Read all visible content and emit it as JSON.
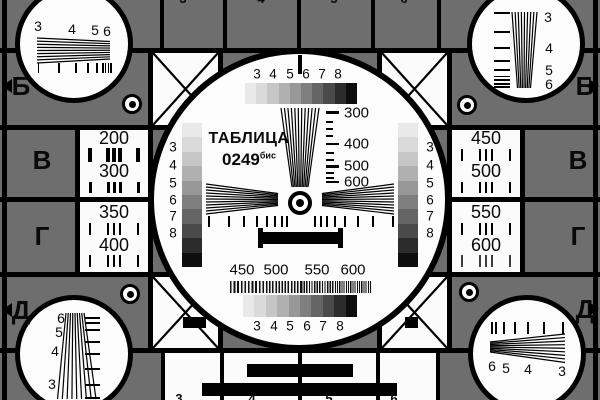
{
  "colors": {
    "background_gray": "#6e6e6e",
    "line_black": "#000000",
    "cell_white": "#fbfbfb"
  },
  "title": {
    "name": "ТАБЛИЦА",
    "number": "0249",
    "suffix": "бис"
  },
  "edge_markers": {
    "left": [
      "Б",
      "В",
      "Г",
      "Д"
    ],
    "right": [
      "Б",
      "В",
      "Г",
      "Д"
    ]
  },
  "resolution_cells": {
    "left_top": [
      "200",
      "300"
    ],
    "left_bottom": [
      "350",
      "400"
    ],
    "right_top": [
      "450",
      "500"
    ],
    "right_bottom": [
      "550",
      "600"
    ]
  },
  "grayscale_labels": [
    "3",
    "4",
    "5",
    "6",
    "7",
    "8"
  ],
  "side_scale_labels": [
    "3",
    "4",
    "5",
    "6",
    "7",
    "8"
  ],
  "center_frequency_scale": [
    "300",
    "400",
    "500",
    "600"
  ],
  "burst_labels": [
    "450",
    "500",
    "550",
    "600"
  ],
  "corner_wedge_labels": {
    "top_left": [
      "3",
      "4",
      "5",
      "6"
    ],
    "top_right": [
      "3",
      "4",
      "5",
      "6"
    ],
    "bottom_left": [
      "6",
      "5",
      "4",
      "3"
    ],
    "bottom_right": [
      "6",
      "5",
      "4",
      "3"
    ]
  },
  "edge_digits_top": [
    "3",
    "4",
    "5",
    "6"
  ],
  "edge_digits_bottom": [
    "3",
    "4",
    "5",
    "6"
  ],
  "grayscale_steps": [
    "#e9e9e9",
    "#dadada",
    "#c6c6c6",
    "#b0b0b0",
    "#989898",
    "#7f7f7f",
    "#656565",
    "#4a4a4a",
    "#2c2c2c",
    "#0e0e0e"
  ]
}
